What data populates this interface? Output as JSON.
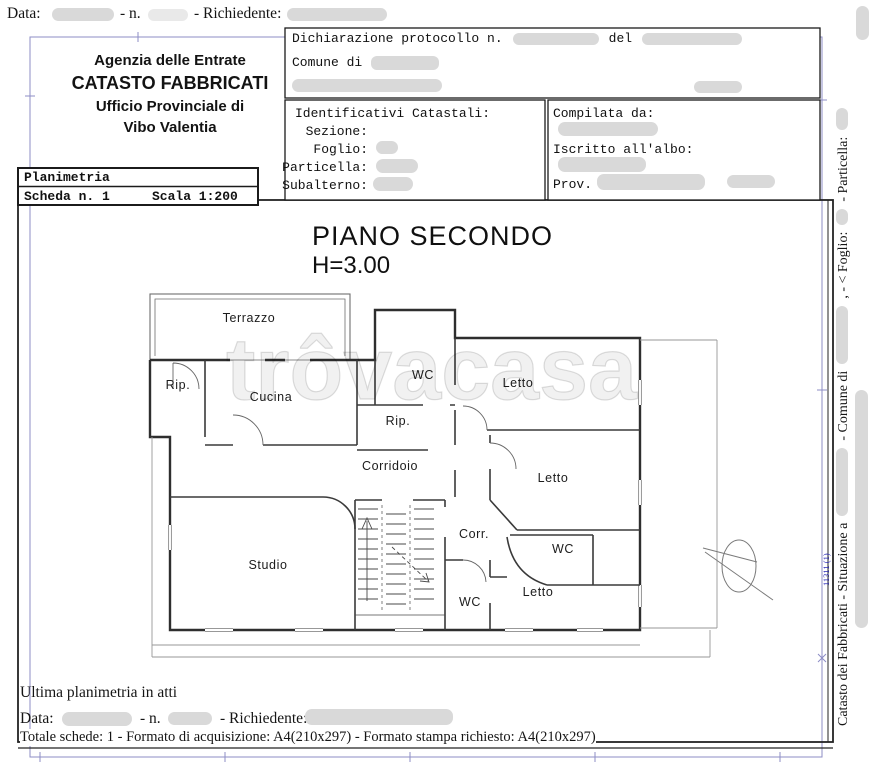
{
  "colors": {
    "redaction": "#d9d9d9",
    "redaction_light": "#e9e9e9",
    "frame_blue": "#8d8dc6",
    "annotation_blue": "#2a2ab8",
    "wall": "#2e2e2e"
  },
  "top_line": {
    "data_label": "Data:",
    "n_label": "- n.",
    "richiedente_label": "- Richiedente:"
  },
  "header": {
    "agency": {
      "line1": "Agenzia delle Entrate",
      "line2": "CATASTO FABBRICATI",
      "line3": "Ufficio Provinciale di",
      "line4": "Vibo Valentia"
    },
    "dichiarazione": {
      "protocollo_label": "Dichiarazione protocollo n.",
      "del_label": "del",
      "comune_label": "Comune di"
    },
    "identificativi": {
      "title": "Identificativi Catastali:",
      "sezione": "Sezione:",
      "foglio": "Foglio:",
      "particella": "Particella:",
      "subalterno": "Subalterno:"
    },
    "compilata": {
      "compilata_label": "Compilata da:",
      "iscritto_label": "Iscritto all'albo:",
      "prov_label": "Prov."
    },
    "planimetria": {
      "title": "Planimetria",
      "scheda": "Scheda n. 1",
      "scala": "Scala 1:200"
    }
  },
  "plan": {
    "title": "PIANO SECONDO",
    "height_label": "H=3.00",
    "watermark": "trôvacasa",
    "rooms": [
      "Terrazzo",
      "Rip.",
      "Cucina",
      "WC",
      "Letto",
      "Rip.",
      "Corridoio",
      "Letto",
      "Studio",
      "Corr.",
      "WC",
      "Letto",
      "WC"
    ]
  },
  "right_margin": {
    "seg_catasto": "Catasto dei Fabbricati - Situazione a",
    "seg_comune": "- Comune di",
    "seg_foglio": ", - < Foglio:",
    "seg_particella": "- Particella:",
    "blue_annotation": "11311 (1)"
  },
  "footer": {
    "ultima": "Ultima planimetria in atti",
    "data_label": "Data:",
    "n_label": "- n.",
    "richiedente_label": "- Richiedente:",
    "totale": "Totale schede: 1 - Formato di acquisizione: A4(210x297)  - Formato stampa richiesto: A4(210x297)"
  }
}
